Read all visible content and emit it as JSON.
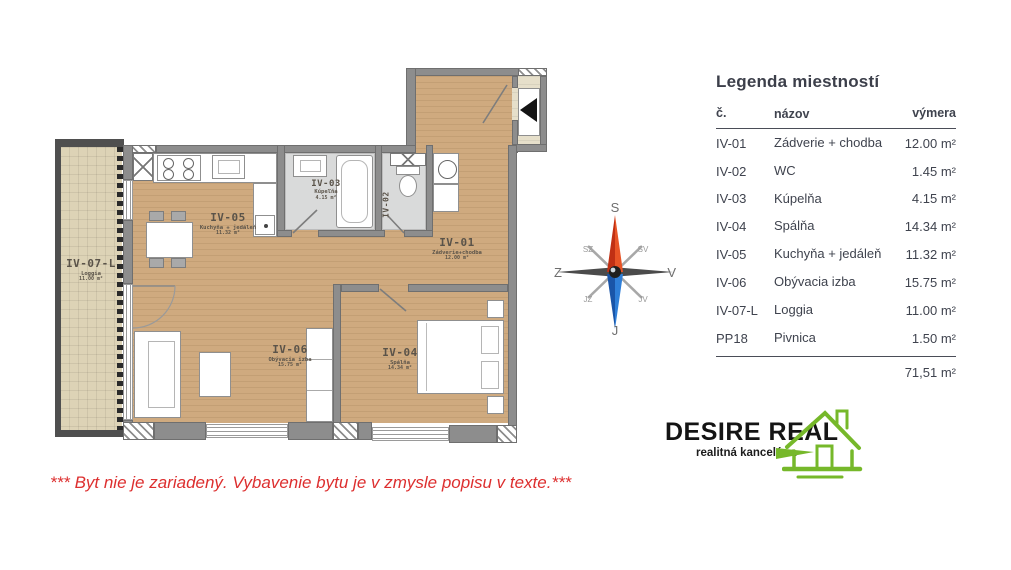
{
  "legend": {
    "title": "Legenda miestností",
    "columns": {
      "no": "č.",
      "name": "názov",
      "area": "výmera"
    },
    "rows": [
      {
        "no": "IV-01",
        "name": "Zádverie + chodba",
        "area": "12.00 m²"
      },
      {
        "no": "IV-02",
        "name": "WC",
        "area": "1.45 m²"
      },
      {
        "no": "IV-03",
        "name": "Kúpelňa",
        "area": "4.15 m²"
      },
      {
        "no": "IV-04",
        "name": "Spálňa",
        "area": "14.34 m²"
      },
      {
        "no": "IV-05",
        "name": "Kuchyňa + jedáleň",
        "area": "11.32 m²"
      },
      {
        "no": "IV-06",
        "name": "Obývacia izba",
        "area": "15.75 m²"
      },
      {
        "no": "IV-07-L",
        "name": "Loggia",
        "area": "11.00 m²"
      },
      {
        "no": "PP18",
        "name": "Pivnica",
        "area": "1.50 m²"
      }
    ],
    "total": "71,51 m²"
  },
  "plan": {
    "rooms": {
      "iv01": {
        "id": "IV-01",
        "name": "Zádverie+chodba",
        "area": "12.00 m²"
      },
      "iv02": {
        "id": "IV-02"
      },
      "iv03": {
        "id": "IV-03",
        "name": "Kúpeľňa",
        "area": "4.15 m²"
      },
      "iv04": {
        "id": "IV-04",
        "name": "Spálňa",
        "area": "14.34 m²"
      },
      "iv05": {
        "id": "IV-05",
        "name": "Kuchyňa + jedáleň",
        "area": "11.32 m²"
      },
      "iv06": {
        "id": "IV-06",
        "name": "Obývacia izba",
        "area": "15.75 m²"
      },
      "iv07": {
        "id": "IV-07-L",
        "name": "Loggia",
        "area": "11.00 m²"
      }
    }
  },
  "compass": {
    "n": "S",
    "s": "J",
    "w": "Z",
    "e": "V",
    "nw": "SZ",
    "ne": "SV",
    "sw": "JZ",
    "se": "JV"
  },
  "logo": {
    "title": "DESIRE REAL",
    "subtitle": "realitná kancelária"
  },
  "disclaimer": "*** Byt nie je zariadený. Vybavenie bytu je v zmysle popisu v texte.***",
  "colors": {
    "logo_green": "#76b82a",
    "disclaimer_red": "#dd2f2f",
    "compass_red": "#d13a1c",
    "compass_blue": "#2f7fd8",
    "wall_gray": "#8d8d8d",
    "wood_floor": "#cfaa7f",
    "loggia_floor": "#ddd3b6"
  }
}
